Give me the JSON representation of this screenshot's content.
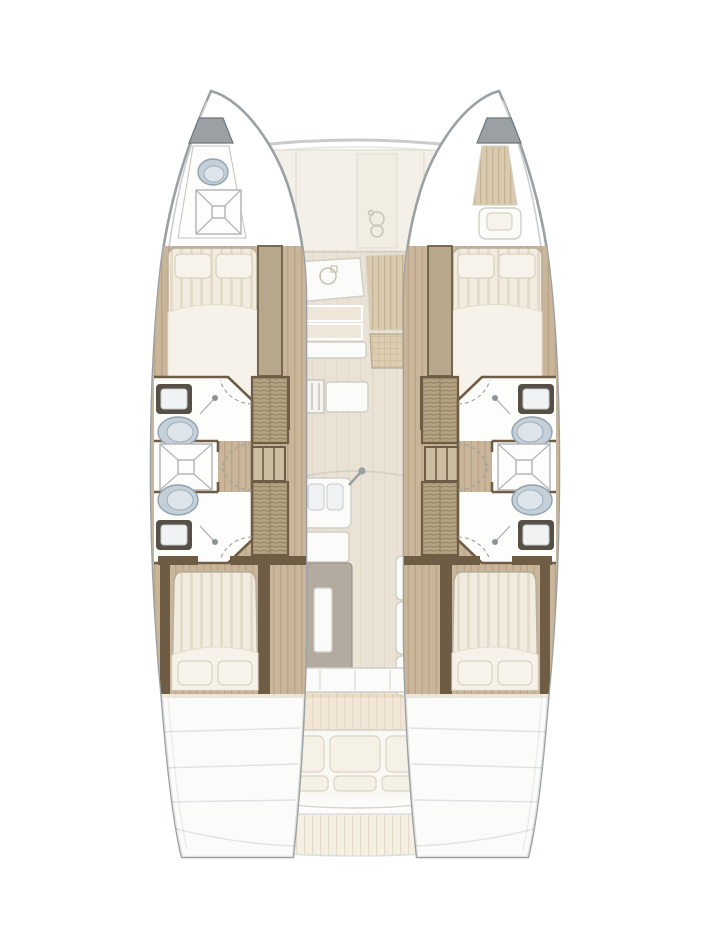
{
  "diagram": {
    "label": "Catamaran accommodation and deck floor plan, top-down, bow up",
    "type": "yacht-floor-plan",
    "orientation": "bow-up",
    "symmetry": "port and starboard hulls mirrored about centerline",
    "port_hull": {
      "bow_compartment": {
        "features": [
          "sea-toilet",
          "shower-tray"
        ]
      },
      "forward_cabin": {
        "features": [
          "double-berth",
          "two-pillows",
          "hanging-partition"
        ]
      },
      "mid_section": {
        "features": [
          "washbasin-forward",
          "toilet-forward",
          "shared-shower-cubicle",
          "toilet-aft",
          "washbasin-aft",
          "two-hanging-lockers",
          "companionway-steps",
          "four-door-swing-arcs"
        ]
      },
      "aft_cabin": {
        "features": [
          "double-berth",
          "two-pillows"
        ]
      },
      "stern": {
        "features": [
          "transom-steps"
        ]
      }
    },
    "starboard_hull": {
      "bow_compartment": {
        "features": [
          "sail-locker",
          "single-berth-cushion",
          "pillow"
        ]
      },
      "note": "remaining layout mirrors port hull"
    },
    "bridgedeck": {
      "foredeck": {
        "features": [
          "deck-panel",
          "panel-seams",
          "windlass"
        ]
      },
      "saloon": {
        "features": [
          "nav-counter-with-sink-ring",
          "galley-counters",
          "stove-unit",
          "dinette-striped-panel",
          "dinette-wicker-panel",
          "galley-island-two-basins",
          "faucet",
          "island-cabinet",
          "saloon-table-with-leaf",
          "side-seat",
          "fridge-units-x3",
          "aft-sliding-door"
        ]
      },
      "cockpit": {
        "features": [
          "planked-deck",
          "aft-bench-sofa",
          "three-back-cushions",
          "three-seat-cushions",
          "stern-platform",
          "swim-steps"
        ]
      }
    },
    "counts": {
      "cabins": 4,
      "bathrooms": 4,
      "showers": 3,
      "toilets": 5,
      "washbasins": 4
    },
    "colors_note": "beige/tan interior woodwork on white hull background"
  },
  "colors": {
    "hull-outline": "#9aa0a3",
    "hull-inner": "#cbced0",
    "hull-fill": "#ffffff",
    "wood-floor": "#c9b69a",
    "wood-grain": "#bba586",
    "wood-dark": "#6f5c45",
    "locker": "#b4a383",
    "locker-line": "#8d7c5f",
    "partition": "#b7a88c",
    "mattress": "#f1ecdf",
    "mattress-stripe": "#e4dcc8",
    "duvet": "#f6f2e9",
    "pillow": "#f7f3ea",
    "pillow-edge": "#d9d2c0",
    "toilet": "#c3d0da",
    "toilet-edge": "#93a2ae",
    "toilet-inner": "#dde5ea",
    "sink-frame": "#575046",
    "basin": "#f0f2f3",
    "fixture-line": "#b4b7b9",
    "saloon-floor": "#eae2d4",
    "saloon-stripe": "#e3dac9",
    "counter-cream": "#efe8da",
    "white-unit": "#fbfbf9",
    "unit-edge": "#cfcfc8",
    "table": "#b3aaa0",
    "table-edge": "#9d958a",
    "deck-plank": "#ead9bd",
    "deck-line": "#d9c6a6",
    "deck-light": "#f0e7d4",
    "exterior-panel": "#efe9dc",
    "exterior-line": "#d8d2c2",
    "hatch-grey": "#9aa0a4",
    "arc-dash": "#9aa0a3"
  }
}
